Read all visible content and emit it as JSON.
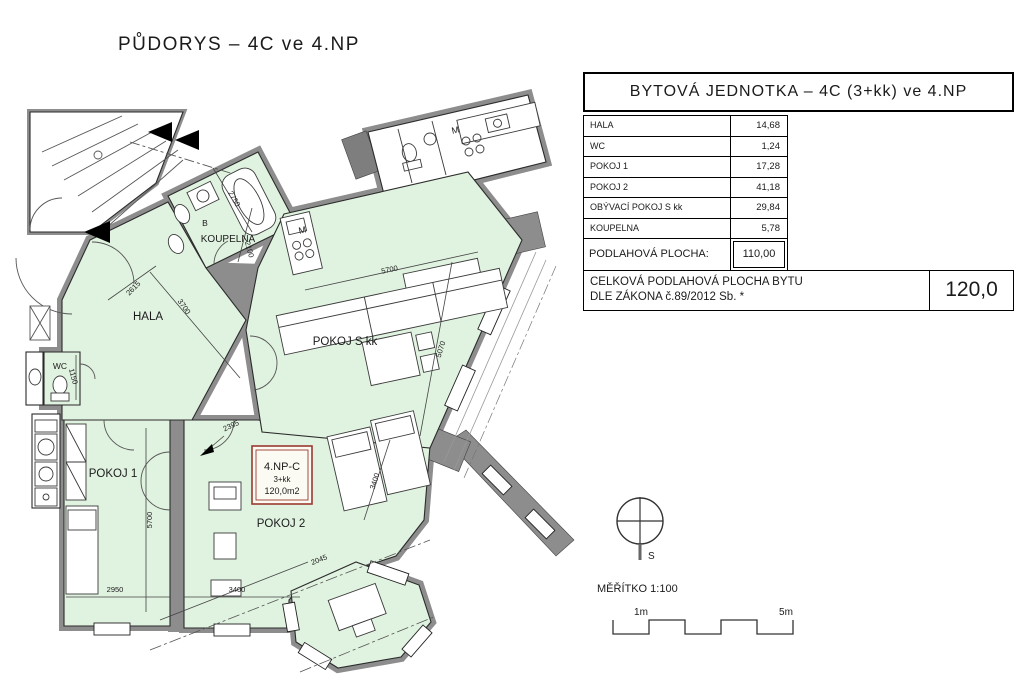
{
  "title": "PŮDORYS – 4C ve 4.NP",
  "table": {
    "header": "BYTOVÁ JEDNOTKA – 4C (3+kk) ve 4.NP",
    "rows": [
      {
        "label": "HALA",
        "value": "14,68"
      },
      {
        "label": "WC",
        "value": "1,24"
      },
      {
        "label": "POKOJ 1",
        "value": "17,28"
      },
      {
        "label": "POKOJ 2",
        "value": "41,18"
      },
      {
        "label": "OBÝVACÍ POKOJ S kk",
        "value": "29,84"
      },
      {
        "label": "KOUPELNA",
        "value": "5,78"
      }
    ],
    "subtotal": {
      "label": "PODLAHOVÁ PLOCHA:",
      "value": "110,00"
    },
    "total": {
      "label_line1": "CELKOVÁ PODLAHOVÁ PLOCHA BYTU",
      "label_line2": "DLE ZÁKONA č.89/2012 Sb. *",
      "value": "120,0"
    }
  },
  "plan": {
    "rooms": {
      "hala": "HALA",
      "koupelna": "KOUPELNA",
      "wc": "WC",
      "pokoj1": "POKOJ 1",
      "pokoj2": "POKOJ 2",
      "pokoj_s_kk": "POKOJ S kk",
      "b": "B",
      "m_kitchen": "M",
      "m_neighbor": "M"
    },
    "unit_box": {
      "line1": "4.NP-C",
      "line2": "3+kk",
      "line3": "120,0m2"
    },
    "dimensions": [
      "2750",
      "2100",
      "2615",
      "3700",
      "5700",
      "1150",
      "5700",
      "2950",
      "3400",
      "3400",
      "2395",
      "2045",
      "5070"
    ],
    "colors": {
      "room_fill": "#e0f2e0",
      "wall": "#8d8d8d",
      "unit_box_border": "#9c3a30"
    }
  },
  "legend": {
    "north_label": "S",
    "scale_label": "MĚŘÍTKO 1:100",
    "scale_start": "1m",
    "scale_end": "5m"
  }
}
